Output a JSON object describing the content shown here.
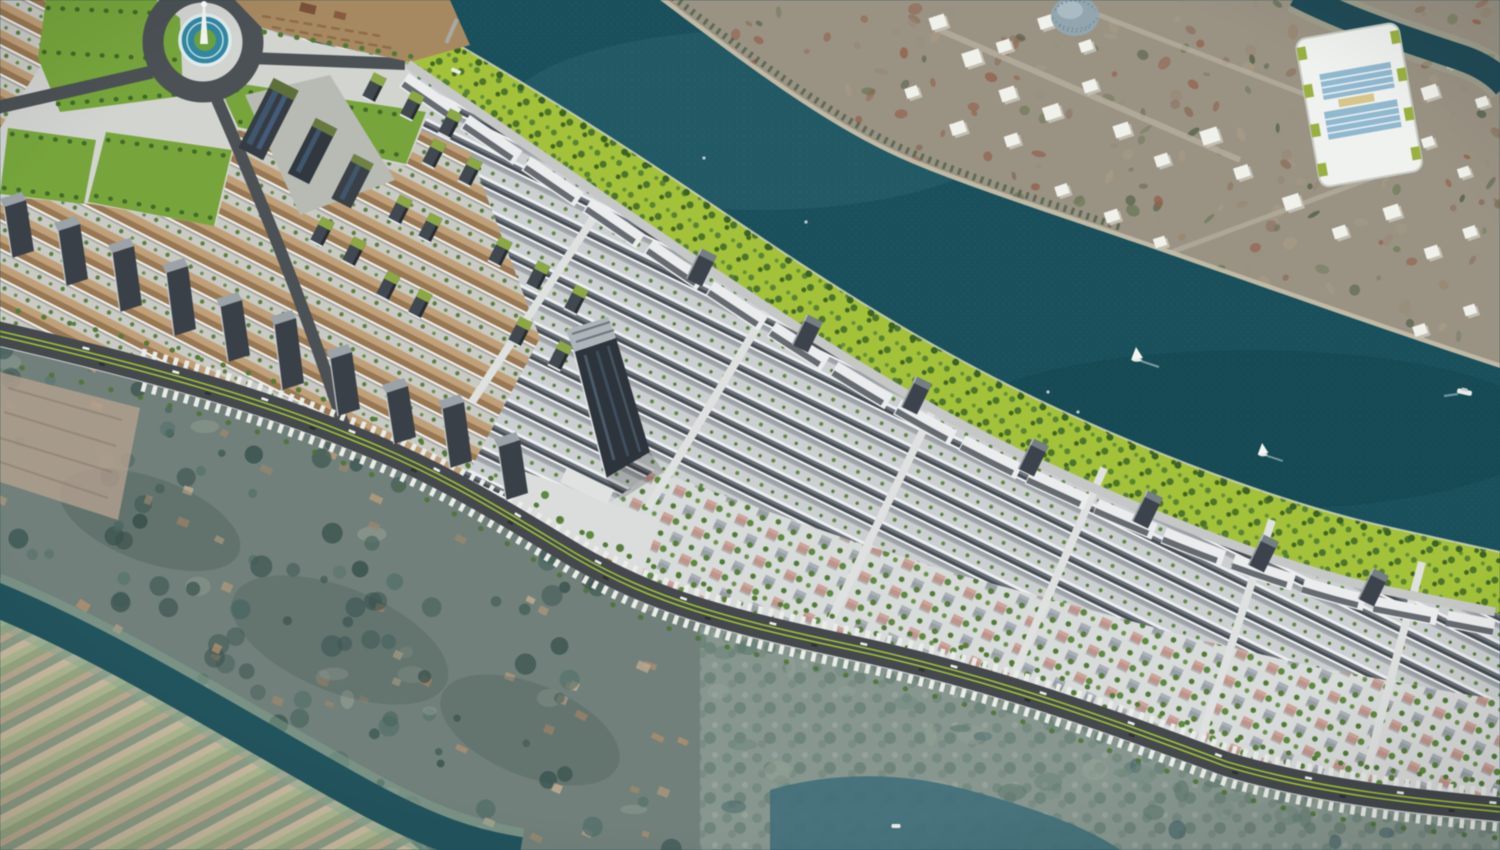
{
  "scene": {
    "type": "3d-aerial-masterplan-render",
    "description": "Bird's-eye 3D visualization of a riverside township master plan: long rows of shophouses, villa quarters, a central high-rise tower, a landscaped chartreuse riverfront promenade along a dark teal river with sailboats, an existing town (satellite imagery) across the river with white massing blocks, and village, fields and a canal in the foreground.",
    "boats": [
      {
        "kind": "sailboat",
        "x": 1137,
        "y": 357,
        "s": 1.0
      },
      {
        "kind": "sailboat",
        "x": 1263,
        "y": 452,
        "s": 0.9
      },
      {
        "kind": "ship",
        "x": 1464,
        "y": 392,
        "s": 1.0
      },
      {
        "kind": "ferry",
        "x": 456,
        "y": 71,
        "s": 1.0
      },
      {
        "kind": "boat",
        "x": 896,
        "y": 826,
        "s": 1.0
      },
      {
        "kind": "speck",
        "x": 1048,
        "y": 392,
        "s": 1
      },
      {
        "kind": "speck",
        "x": 1078,
        "y": 412,
        "s": 1
      },
      {
        "kind": "speck",
        "x": 704,
        "y": 158,
        "s": 1
      },
      {
        "kind": "speck",
        "x": 806,
        "y": 222,
        "s": 1
      }
    ],
    "green_roof_blocks": [
      {
        "x": 374,
        "y": 88
      },
      {
        "x": 412,
        "y": 106
      },
      {
        "x": 450,
        "y": 124
      },
      {
        "x": 434,
        "y": 154
      },
      {
        "x": 470,
        "y": 172
      },
      {
        "x": 400,
        "y": 210
      },
      {
        "x": 430,
        "y": 228
      },
      {
        "x": 322,
        "y": 232
      },
      {
        "x": 354,
        "y": 252
      },
      {
        "x": 388,
        "y": 286
      },
      {
        "x": 420,
        "y": 304
      },
      {
        "x": 500,
        "y": 252
      },
      {
        "x": 538,
        "y": 276
      },
      {
        "x": 576,
        "y": 300
      },
      {
        "x": 520,
        "y": 332
      },
      {
        "x": 560,
        "y": 356
      }
    ],
    "boulevard_slabs": [
      {
        "x": 12,
        "y": 258,
        "h": 58
      },
      {
        "x": 66,
        "y": 286,
        "h": 62
      },
      {
        "x": 120,
        "y": 312,
        "h": 66
      },
      {
        "x": 174,
        "y": 336,
        "h": 70
      },
      {
        "x": 228,
        "y": 362,
        "h": 62
      },
      {
        "x": 282,
        "y": 390,
        "h": 72
      },
      {
        "x": 338,
        "y": 416,
        "h": 64
      },
      {
        "x": 394,
        "y": 444,
        "h": 58
      },
      {
        "x": 450,
        "y": 468,
        "h": 66
      },
      {
        "x": 506,
        "y": 500,
        "h": 60
      }
    ],
    "terrace_slabs": [
      {
        "x": 700,
        "y": 270
      },
      {
        "x": 806,
        "y": 336
      },
      {
        "x": 915,
        "y": 398
      },
      {
        "x": 1032,
        "y": 460
      },
      {
        "x": 1146,
        "y": 512
      },
      {
        "x": 1262,
        "y": 556
      },
      {
        "x": 1372,
        "y": 590
      }
    ],
    "massing_blocks": [
      {
        "x": 938,
        "y": 22,
        "s": 16
      },
      {
        "x": 972,
        "y": 58,
        "s": 18
      },
      {
        "x": 1008,
        "y": 94,
        "s": 16
      },
      {
        "x": 912,
        "y": 92,
        "s": 13
      },
      {
        "x": 958,
        "y": 128,
        "s": 15
      },
      {
        "x": 1012,
        "y": 140,
        "s": 14
      },
      {
        "x": 1052,
        "y": 112,
        "s": 17
      },
      {
        "x": 1090,
        "y": 86,
        "s": 14
      },
      {
        "x": 1122,
        "y": 130,
        "s": 16
      },
      {
        "x": 1162,
        "y": 160,
        "s": 14
      },
      {
        "x": 1210,
        "y": 136,
        "s": 18
      },
      {
        "x": 1242,
        "y": 172,
        "s": 15
      },
      {
        "x": 1292,
        "y": 202,
        "s": 17
      },
      {
        "x": 1340,
        "y": 232,
        "s": 14
      },
      {
        "x": 1392,
        "y": 212,
        "s": 16
      },
      {
        "x": 1432,
        "y": 252,
        "s": 14
      },
      {
        "x": 1470,
        "y": 232,
        "s": 13
      },
      {
        "x": 1062,
        "y": 190,
        "s": 13
      },
      {
        "x": 1112,
        "y": 216,
        "s": 14
      },
      {
        "x": 1160,
        "y": 242,
        "s": 12
      },
      {
        "x": 1004,
        "y": 46,
        "s": 14
      },
      {
        "x": 1046,
        "y": 22,
        "s": 15
      },
      {
        "x": 1086,
        "y": 46,
        "s": 13
      },
      {
        "x": 1330,
        "y": 152,
        "s": 13
      },
      {
        "x": 1430,
        "y": 92,
        "s": 16
      },
      {
        "x": 1452,
        "y": 62,
        "s": 13
      },
      {
        "x": 1482,
        "y": 102,
        "s": 12
      },
      {
        "x": 1428,
        "y": 142,
        "s": 12
      },
      {
        "x": 1464,
        "y": 172,
        "s": 12
      },
      {
        "x": 1210,
        "y": 300,
        "s": 13
      },
      {
        "x": 1262,
        "y": 330,
        "s": 14
      },
      {
        "x": 1312,
        "y": 356,
        "s": 12
      },
      {
        "x": 1420,
        "y": 330,
        "s": 13
      },
      {
        "x": 1470,
        "y": 310,
        "s": 12
      }
    ],
    "generators": {
      "farcity": {
        "count": 360,
        "seed": 11
      },
      "village": {
        "count": 300,
        "seed": 7
      },
      "marsh": {
        "count": 90,
        "seed": 21
      }
    }
  },
  "colors": {
    "river": "#16505c",
    "riverGlint": "#2a6a76",
    "channel": "#1d4a57",
    "canal": "#1e545e",
    "canalBank": "#86a892",
    "waterBR": "#3f707c",
    "farBase": "#9b9383",
    "farRoad": "#b7b0a0",
    "farSand": "#c7bfa8",
    "farVeg": "#4e6149",
    "embank": "#a3c433",
    "embankTreeA": "#57852f",
    "embankTreeB": "#4a7429",
    "waterEdgeTrees": "#3a6322",
    "devBase": "#cdd1d3",
    "parkBase": "#d4d6d2",
    "lawn": "#76a737",
    "lawnTrees": "#3f6b26",
    "beach": "#a9895e",
    "asphalt": "#44484d",
    "asphaltRing": "#4b5054",
    "median": "#9fc32f",
    "sawtooth": "#eceeea",
    "roadEdge": "#d8dad6",
    "drive": "#c6c9c8",
    "terraceWhite": "#eceeef",
    "terraceShade": "#4e545b",
    "towerBody": "#2b333a",
    "towerTop": "#aeb6bc",
    "towerGlass": "#4e6174",
    "slabDark": "#383f46",
    "slabTop": "#9ba3a9",
    "greenRoof": "#8ba93f",
    "blockSide": "#c2bfb2",
    "blockTop": "#f3f3ee",
    "poolWater": "#2e88a2",
    "poolRim": "#dfeef2",
    "island": "#6aa23c",
    "monument": "#f6f7f4",
    "villageBase": "#70807a",
    "pinkFields": "#b5a090",
    "stadiumWhite": "#f2f4f1",
    "stadiumBlue": "#8fb9d2",
    "stadiumYellow": "#d9c787",
    "bush": "#9ab33c",
    "tank": "#93a7b2",
    "boatWhite": "#eceeea",
    "carWhite": "#f2f3f0",
    "carDark": "#2a2d30",
    "farcityPalette": [
      "#9a8672",
      "#8a6d58",
      "#96604b",
      "#97917f",
      "#6e7a58",
      "#55624a",
      "#a89a84"
    ],
    "villagePaletteTrees": [
      "#47625c",
      "#3a534e",
      "#52706a",
      "#3f5a54"
    ],
    "villagePaletteHouses": [
      "#b59a7c",
      "#c2ac8e",
      "#97876f",
      "#b28f6e"
    ],
    "marshPalette": [
      "#5f7a70",
      "#708a7e",
      "#93a396",
      "#46656c"
    ]
  }
}
